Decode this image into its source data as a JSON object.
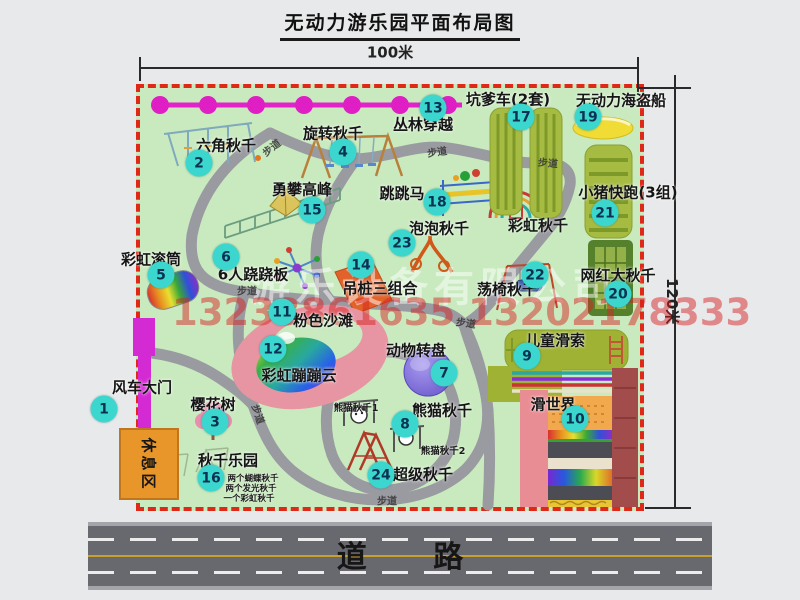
{
  "title": "无动力游乐园平面布局图",
  "dimensions": {
    "top": "100米",
    "right": "120米"
  },
  "road": {
    "label": "道 路"
  },
  "watermarks": {
    "company": "游乐设备有限公司",
    "phone": "13233861635 13202178333"
  },
  "rest_area": {
    "label": "休息区"
  },
  "map": {
    "items": [
      {
        "num": "1",
        "label": "风车大门",
        "bx": 104,
        "by": 409,
        "lx": 142,
        "ly": 387
      },
      {
        "num": "2",
        "label": "六角秋千",
        "bx": 199,
        "by": 163,
        "lx": 226,
        "ly": 145
      },
      {
        "num": "3",
        "label": "樱花树",
        "bx": 215,
        "by": 422,
        "lx": 213,
        "ly": 404
      },
      {
        "num": "4",
        "label": "旋转秋千",
        "bx": 343,
        "by": 152,
        "lx": 333,
        "ly": 133
      },
      {
        "num": "5",
        "label": "彩虹滚筒",
        "bx": 161,
        "by": 275,
        "lx": 151,
        "ly": 259
      },
      {
        "num": "6",
        "label": "6人跷跷板",
        "bx": 226,
        "by": 257,
        "lx": 253,
        "ly": 274
      },
      {
        "num": "7",
        "label": "动物转盘",
        "bx": 444,
        "by": 373,
        "lx": 416,
        "ly": 350
      },
      {
        "num": "8",
        "label": "熊猫秋千",
        "bx": 405,
        "by": 424,
        "lx": 442,
        "ly": 410
      },
      {
        "num": "9",
        "label": "儿童滑索",
        "bx": 527,
        "by": 356,
        "lx": 555,
        "ly": 340
      },
      {
        "num": "10",
        "label": "滑世界",
        "bx": 575,
        "by": 419,
        "lx": 553,
        "ly": 404
      },
      {
        "num": "11",
        "label": "粉色沙滩",
        "bx": 282,
        "by": 312,
        "lx": 323,
        "ly": 320
      },
      {
        "num": "12",
        "label": "彩虹蹦蹦云",
        "bx": 273,
        "by": 349,
        "lx": 299,
        "ly": 375
      },
      {
        "num": "13",
        "label": "丛林穿越",
        "bx": 433,
        "by": 108,
        "lx": 423,
        "ly": 124
      },
      {
        "num": "14",
        "label": "吊桩三组合",
        "bx": 361,
        "by": 265,
        "lx": 380,
        "ly": 288
      },
      {
        "num": "15",
        "label": "勇攀高峰",
        "bx": 312,
        "by": 210,
        "lx": 302,
        "ly": 189
      },
      {
        "num": "16",
        "label": "秋千乐园",
        "bx": 211,
        "by": 478,
        "lx": 228,
        "ly": 460
      },
      {
        "num": "17",
        "label": "坑爹车(2套)",
        "bx": 521,
        "by": 117,
        "lx": 508,
        "ly": 99
      },
      {
        "num": "18",
        "label": "跳跳马",
        "bx": 437,
        "by": 202,
        "lx": 402,
        "ly": 193
      },
      {
        "num": "19",
        "label": "无动力海盗船",
        "bx": 588,
        "by": 117,
        "lx": 621,
        "ly": 100
      },
      {
        "num": "20",
        "label": "网红大秋千",
        "bx": 618,
        "by": 294,
        "lx": 618,
        "ly": 275
      },
      {
        "num": "21",
        "label": "小猪快跑(3组)",
        "bx": 605,
        "by": 213,
        "lx": 628,
        "ly": 192
      },
      {
        "num": "22",
        "label": "荡椅秋千",
        "bx": 535,
        "by": 275,
        "lx": 507,
        "ly": 289
      },
      {
        "num": "23",
        "label": "泡泡秋千",
        "bx": 402,
        "by": 243,
        "lx": 439,
        "ly": 228
      },
      {
        "num": "24",
        "label": "超级秋千",
        "bx": 381,
        "by": 475,
        "lx": 423,
        "ly": 474
      }
    ],
    "extra_labels": [
      {
        "text": "彩虹秋千",
        "x": 538,
        "y": 225,
        "size": 15
      },
      {
        "text": "熊猫秋千1",
        "x": 356,
        "y": 407,
        "size": 9.5
      },
      {
        "text": "熊猫秋千2",
        "x": 443,
        "y": 450,
        "size": 9.5
      },
      {
        "text": "两个蝴蝶秋千",
        "x": 253,
        "y": 478,
        "size": 8.5
      },
      {
        "text": "两个发光秋千",
        "x": 251,
        "y": 488,
        "size": 8.5
      },
      {
        "text": "一个彩虹秋千",
        "x": 249,
        "y": 498,
        "size": 8.5
      }
    ],
    "path_labels": [
      {
        "text": "步道",
        "x": 271,
        "y": 147,
        "rot": -38
      },
      {
        "text": "步道",
        "x": 437,
        "y": 151,
        "rot": -8
      },
      {
        "text": "步道",
        "x": 548,
        "y": 162,
        "rot": 5
      },
      {
        "text": "步道",
        "x": 247,
        "y": 290,
        "rot": 0
      },
      {
        "text": "步道",
        "x": 466,
        "y": 322,
        "rot": 8
      },
      {
        "text": "步道",
        "x": 259,
        "y": 414,
        "rot": 72
      },
      {
        "text": "步道",
        "x": 387,
        "y": 500,
        "rot": 0
      }
    ]
  },
  "colors": {
    "page-bg": "#e8e9ea",
    "map-bg": "#c9eabf",
    "map-border": "#e02818",
    "badge-bg": "#3bd6ce",
    "badge-text": "#0b3252",
    "road-bg": "#68686f",
    "road-center-line": "#c8a030",
    "chain-magenta": "#e223c8",
    "rest-area-bg": "#e8952a",
    "gate-magenta": "#d42ad4",
    "pad-olive": "#a6bb42",
    "watermark-red": "#d83030"
  }
}
